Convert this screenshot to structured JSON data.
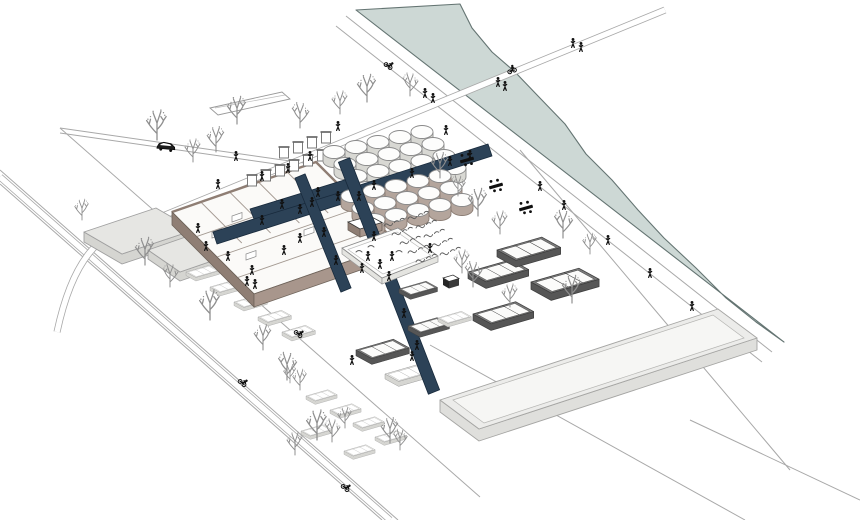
{
  "scene": {
    "alt": "Axonometric architectural site illustration: a riverside industrial plant reused as a public landscape, with fields of circular tanks, a brick hall with roof trusses, raised navy walkways crossing the site, garden beds, water basins, street trees, pedestrians, cyclists, a car and a bridge over the river.",
    "features": [
      "river",
      "river-bridge",
      "riverside-paths",
      "industrial-hall",
      "roof-trusses",
      "circular-tank-field-white",
      "circular-tank-field-taupe",
      "elevated-navy-walkways",
      "walled-garden",
      "crop-beds",
      "picnic-tables",
      "water-basins",
      "planter-boxes",
      "warehouse-tray",
      "gabled-sheds",
      "stepped-sheds",
      "street-trees",
      "pedestrians",
      "cyclists",
      "car"
    ],
    "inventory": {
      "white_tanks": 20,
      "taupe_tanks": 15,
      "picnic_tables": 3,
      "trees": 32,
      "pedestrians": 50,
      "cyclists": 5,
      "cars": 1,
      "bridges": 1
    }
  },
  "colors": {
    "background": "#ffffff",
    "river_fill": "#cdd8d5",
    "river_stroke": "#647472",
    "road_line": "#a8a8a8",
    "walkway": "#2c4257",
    "walkway_stroke": "#182a3c",
    "tree": "#8f8f8f",
    "figure": "#101010",
    "tank_top": "#fdfdfc",
    "tank_stroke": "#8a8a8a",
    "tank_white_wall": "#d8d8d3",
    "tank_taupe_wall": "#b4a59c",
    "building_floor": "#fbfaf8",
    "building_wall_west": "#8f7e74",
    "building_wall_south": "#a8968c",
    "building_stroke": "#6e635a",
    "scribble": "#5a5a5a"
  }
}
